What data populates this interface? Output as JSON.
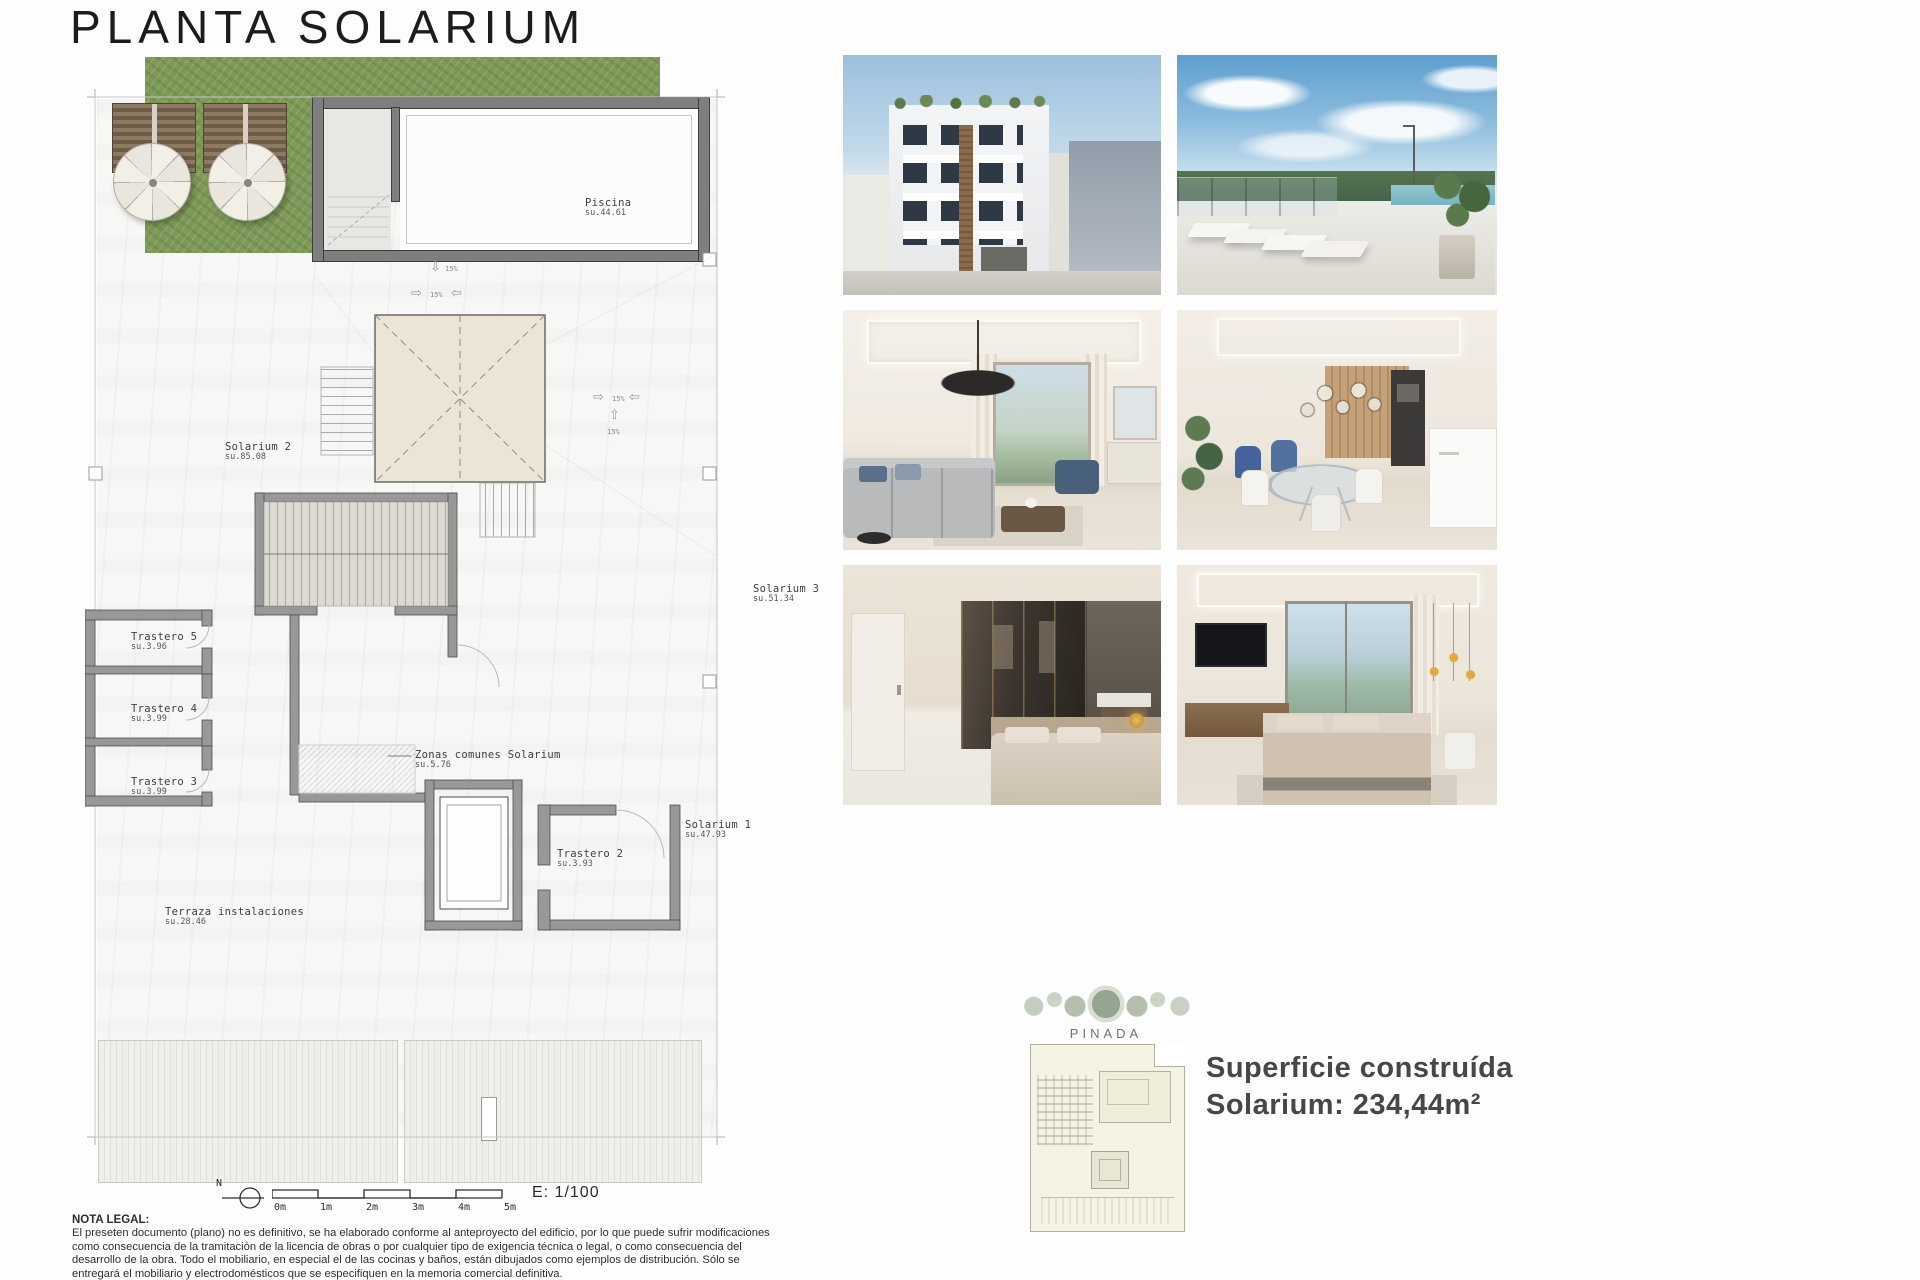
{
  "title": "PLANTA SOLARIUM",
  "plan": {
    "rooms": {
      "piscina": {
        "name": "Piscina",
        "su": "su.44.61"
      },
      "solarium2": {
        "name": "Solarium 2",
        "su": "su.85.08"
      },
      "solarium3": {
        "name": "Solarium 3",
        "su": "su.51.34"
      },
      "trastero5": {
        "name": "Trastero 5",
        "su": "su.3.96"
      },
      "trastero4": {
        "name": "Trastero 4",
        "su": "su.3.99"
      },
      "trastero3": {
        "name": "Trastero 3",
        "su": "su.3.99"
      },
      "zonas": {
        "name": "Zonas comunes Solarium",
        "su": "su.5.76"
      },
      "trastero2": {
        "name": "Trastero 2",
        "su": "su.3.93"
      },
      "solarium1": {
        "name": "Solarium 1",
        "su": "su.47.93"
      },
      "terraza": {
        "name": "Terraza instalaciones",
        "su": "su.28.46"
      }
    },
    "slope_label": "15%",
    "arrows": {
      "up": "⇧",
      "down": "⇩",
      "left": "⇦",
      "right": "⇨"
    },
    "scale": {
      "north": "N",
      "ticks": [
        "0m",
        "1m",
        "2m",
        "3m",
        "4m",
        "5m"
      ],
      "ratio": "E: 1/100"
    }
  },
  "legal": {
    "heading": "NOTA LEGAL:",
    "body": "El preseten documento (plano) no es definitivo, se ha elaborado conforme al anteproyecto del edificio, por lo que puede sufrir modificaciones como consecuencia de la tramitación de la licencia de obras o por cualquier tipo de exigencia técnica o legal, o como consecuencia del desarrollo de la obra. Todo el mobiliario, en especial el de las cocinas y baños, están dibujados como ejemplos de distribución. Sólo se entregará el mobiliario y electrodomésticos que se especifiquen en la memoria comercial definitiva.",
    "footer": "Es un plano meramente informativo, sin contenido contractual."
  },
  "gallery": {
    "photos": [
      {
        "name": "building-exterior"
      },
      {
        "name": "rooftop-pool-terrace"
      },
      {
        "name": "living-room"
      },
      {
        "name": "dining-kitchen"
      },
      {
        "name": "bedroom-dressing"
      },
      {
        "name": "bedroom-window"
      }
    ]
  },
  "brand": {
    "name": "PINADA"
  },
  "summary": {
    "line1": "Superficie construída",
    "line2": "Solarium: 234,44m²"
  },
  "colors": {
    "wall_gray": "#989898",
    "pool_wall": "#7e7e7e",
    "lawn_green": "#7e9a58",
    "skylight_beige": "#ece5d6",
    "text_dark": "#474747"
  }
}
